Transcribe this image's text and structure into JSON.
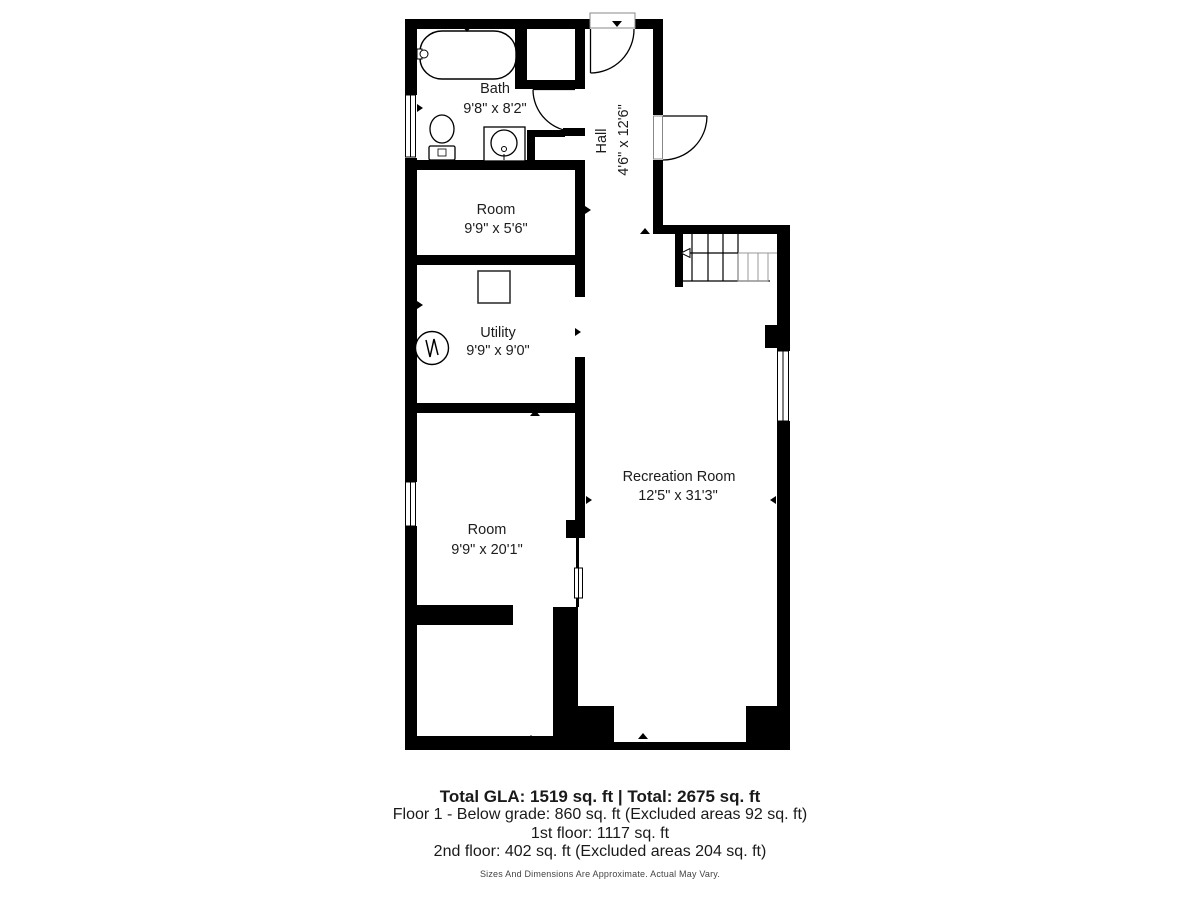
{
  "floorplan": {
    "bath": {
      "name": "Bath",
      "dims": "9'8\" x 8'2\""
    },
    "hall": {
      "name": "Hall",
      "dims": "4'6\" x 12'6\""
    },
    "small_room": {
      "name": "Room",
      "dims": "9'9\" x 5'6\""
    },
    "utility": {
      "name": "Utility",
      "dims": "9'9\" x 9'0\""
    },
    "large_room": {
      "name": "Room",
      "dims": "9'9\" x 20'1\""
    },
    "recreation_room": {
      "name": "Recreation Room",
      "dims": "12'5\" x 31'3\""
    }
  },
  "summary": {
    "total_line": "Total GLA: 1519 sq. ft | Total: 2675 sq. ft",
    "floor1_line": "Floor 1 - Below grade: 860 sq. ft (Excluded areas 92 sq. ft)",
    "floor2_line": "1st floor: 1117 sq. ft",
    "floor3_line": "2nd floor: 402 sq. ft (Excluded areas 204 sq. ft)",
    "disclaimer": "Sizes And Dimensions Are Approximate. Actual May Vary."
  },
  "colors": {
    "wall": "#000000",
    "label_text": "#1c1c1c",
    "summary_text": "#1a1a1a",
    "disclaimer_text": "#444444",
    "stair_detail": "#999999"
  }
}
